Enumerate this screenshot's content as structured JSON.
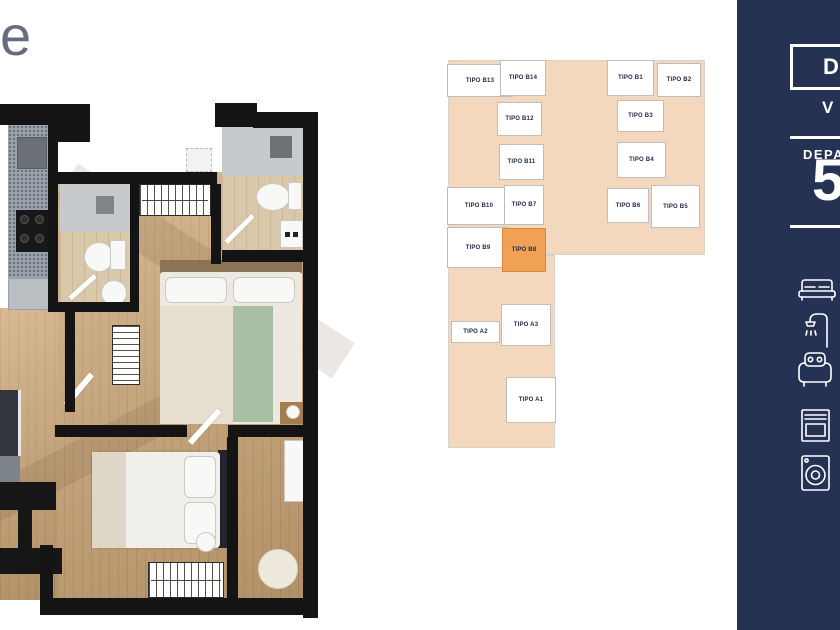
{
  "logo": {
    "letter": "e"
  },
  "colors": {
    "sidebar_bg": "#263253",
    "keyplan_bg": "#f3d8bd",
    "keyplan_highlight": "#f0a156",
    "keyplan_text": "#1d2847",
    "wood_floor": "#cfa878"
  },
  "sidebar": {
    "badge_letter": "D",
    "secondary_letter": "V",
    "section_label": "DEPA",
    "unit_number": "5",
    "icons": [
      "bed-icon",
      "shower-icon",
      "armchair-icon",
      "oven-icon",
      "washing-machine-icon"
    ]
  },
  "keyplan": {
    "blocks": [
      {
        "x": 448,
        "y": 60,
        "w": 257,
        "h": 195
      },
      {
        "x": 448,
        "y": 255,
        "w": 107,
        "h": 193
      }
    ],
    "units": [
      {
        "label": "TIPO B13",
        "x": 447,
        "y": 64,
        "w": 66,
        "h": 33,
        "highlighted": false
      },
      {
        "label": "TIPO B14",
        "x": 500,
        "y": 60,
        "w": 46,
        "h": 36,
        "highlighted": false
      },
      {
        "label": "TIPO B1",
        "x": 607,
        "y": 60,
        "w": 47,
        "h": 36,
        "highlighted": false
      },
      {
        "label": "TIPO B2",
        "x": 657,
        "y": 63,
        "w": 44,
        "h": 34,
        "highlighted": false
      },
      {
        "label": "TIPO B12",
        "x": 497,
        "y": 102,
        "w": 45,
        "h": 34,
        "highlighted": false
      },
      {
        "label": "TIPO B3",
        "x": 617,
        "y": 100,
        "w": 47,
        "h": 32,
        "highlighted": false
      },
      {
        "label": "TIPO B11",
        "x": 499,
        "y": 144,
        "w": 45,
        "h": 36,
        "highlighted": false
      },
      {
        "label": "TIPO B4",
        "x": 617,
        "y": 142,
        "w": 49,
        "h": 36,
        "highlighted": false
      },
      {
        "label": "TIPO B10",
        "x": 447,
        "y": 187,
        "w": 64,
        "h": 38,
        "highlighted": false
      },
      {
        "label": "TIPO B7",
        "x": 504,
        "y": 185,
        "w": 40,
        "h": 40,
        "highlighted": false
      },
      {
        "label": "TIPO B6",
        "x": 607,
        "y": 188,
        "w": 42,
        "h": 35,
        "highlighted": false
      },
      {
        "label": "TIPO B5",
        "x": 651,
        "y": 185,
        "w": 49,
        "h": 43,
        "highlighted": false
      },
      {
        "label": "TIPO B9",
        "x": 447,
        "y": 227,
        "w": 62,
        "h": 41,
        "highlighted": false
      },
      {
        "label": "TIPO B8",
        "x": 502,
        "y": 228,
        "w": 44,
        "h": 44,
        "highlighted": true
      },
      {
        "label": "TIPO A2",
        "x": 451,
        "y": 321,
        "w": 49,
        "h": 22,
        "highlighted": false
      },
      {
        "label": "TIPO A3",
        "x": 501,
        "y": 304,
        "w": 50,
        "h": 42,
        "highlighted": false
      },
      {
        "label": "TIPO A1",
        "x": 506,
        "y": 377,
        "w": 50,
        "h": 46,
        "highlighted": false
      }
    ]
  }
}
